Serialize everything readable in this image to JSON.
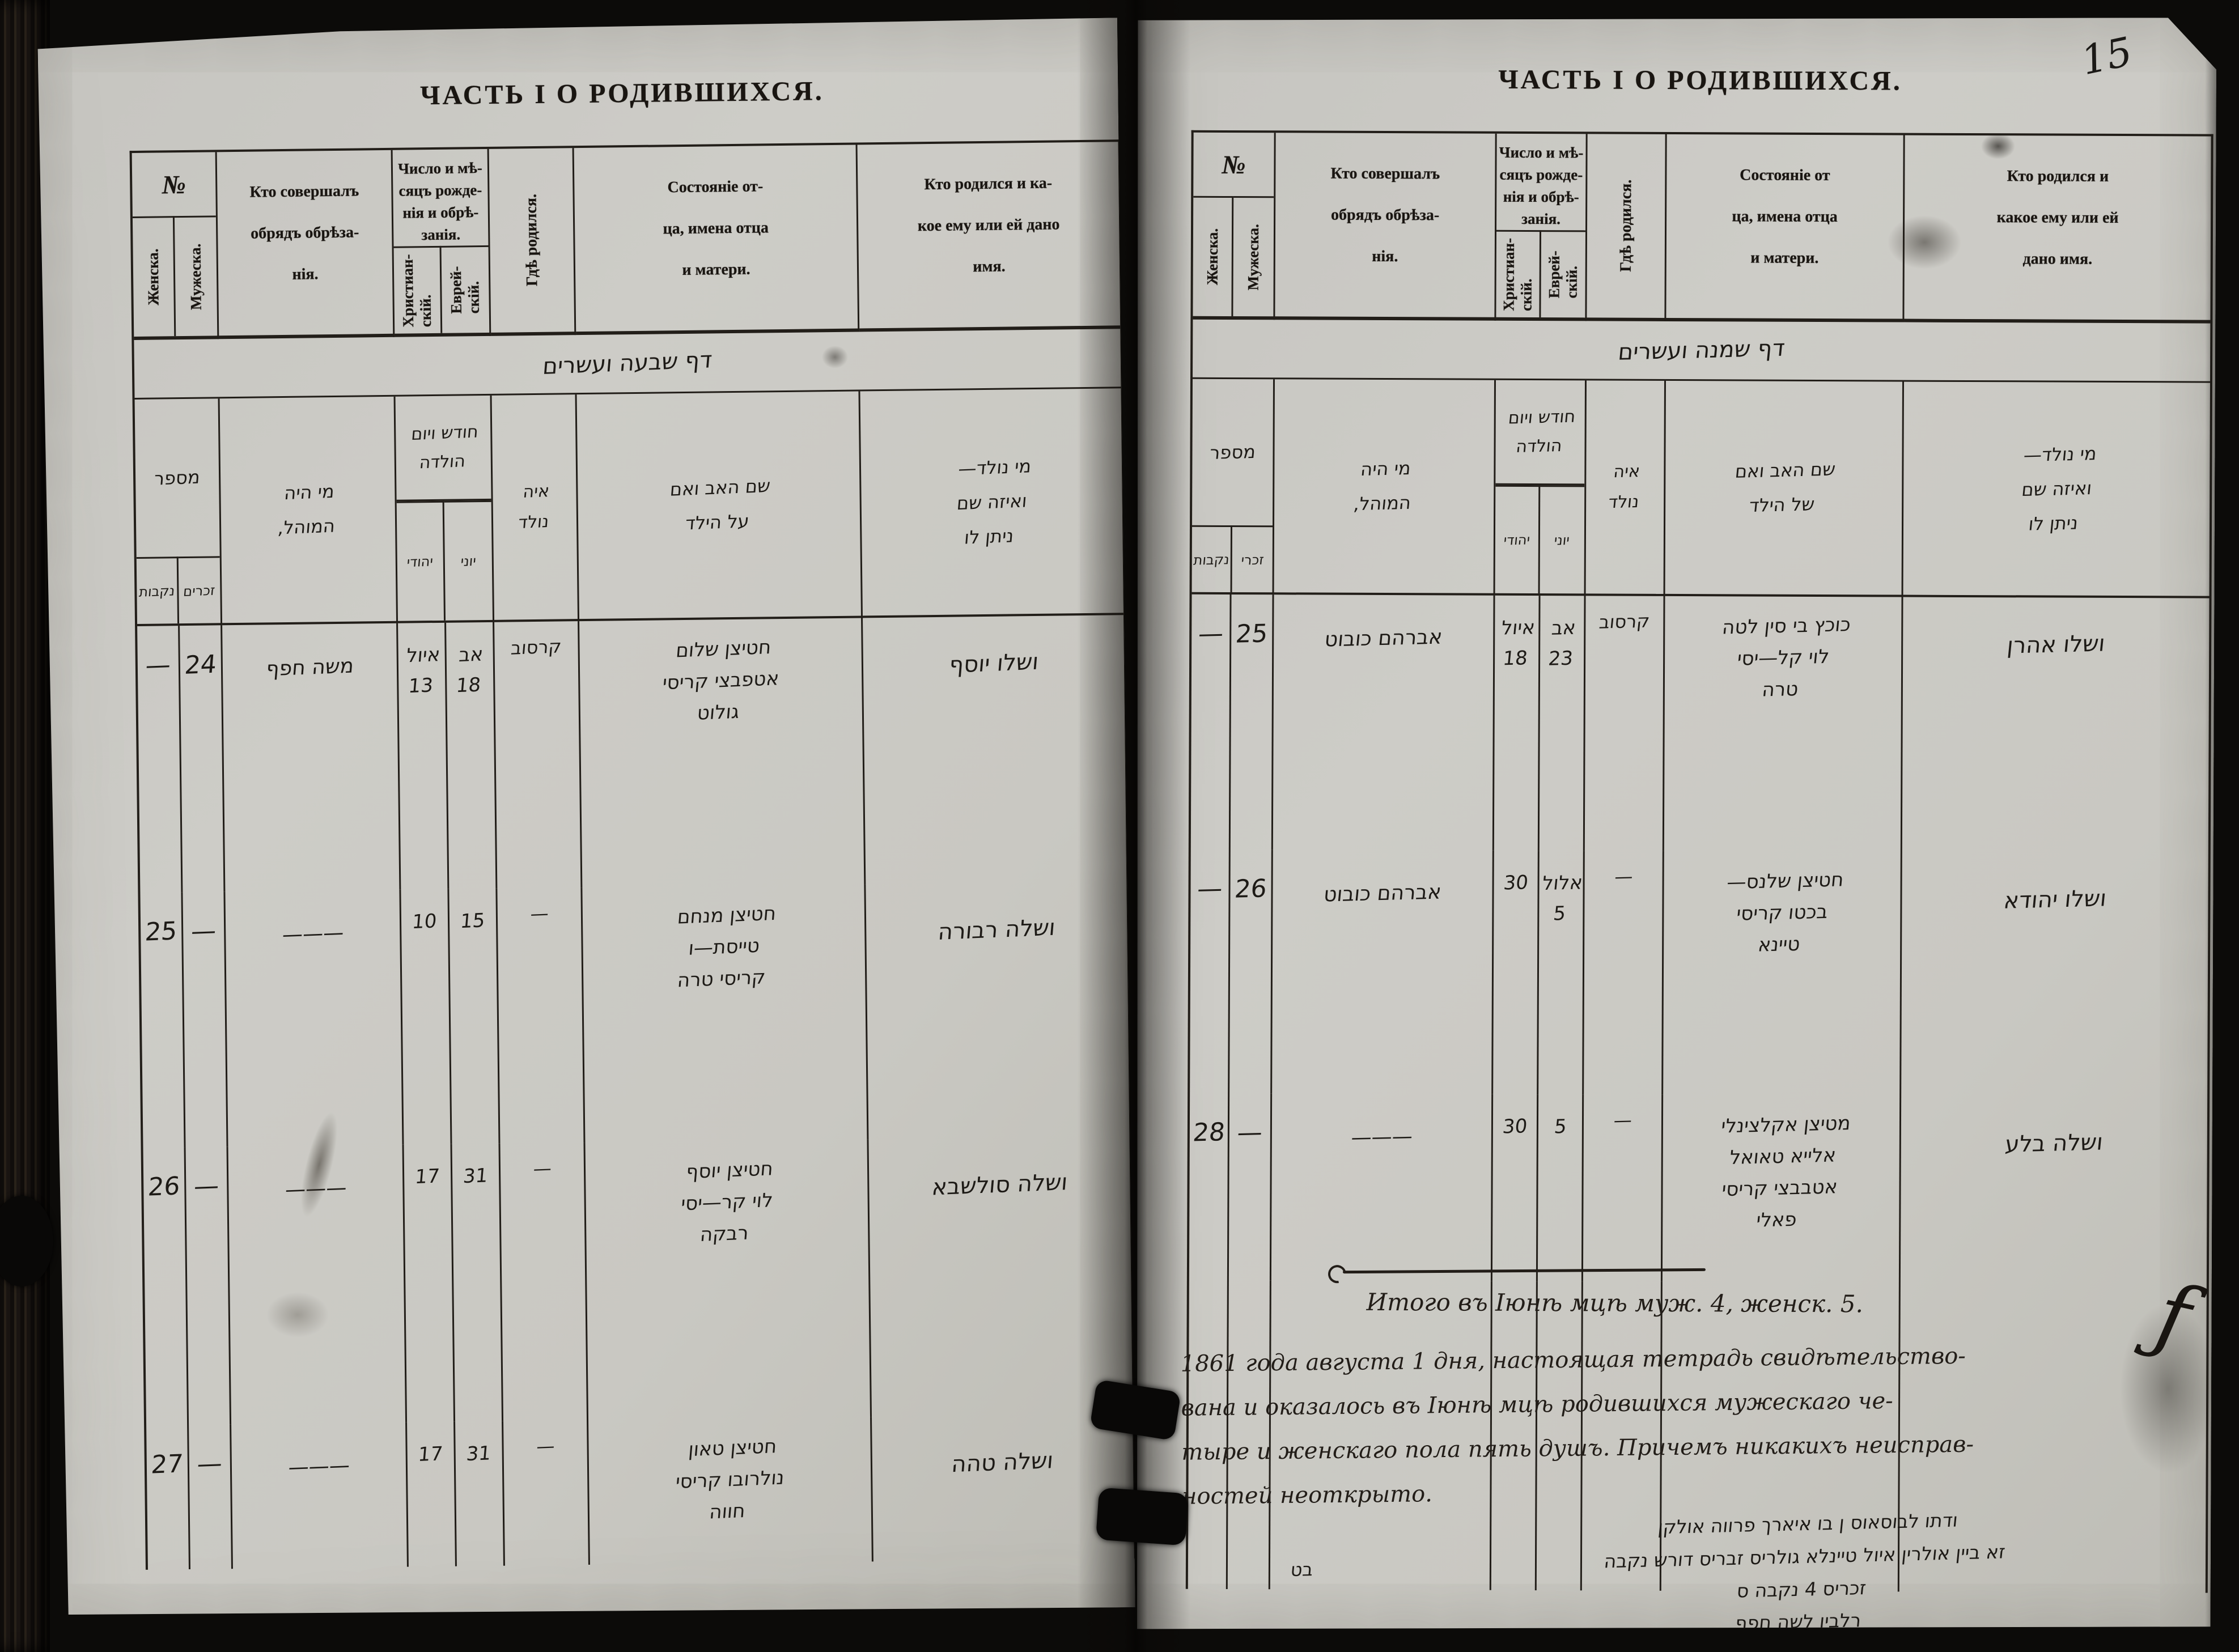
{
  "page_number": "15",
  "left_page": {
    "title": "ЧАСТЬ I О РОДИВШИХСЯ.",
    "printed": {
      "no": "№",
      "female": "Женска.",
      "male": "Мужеска.",
      "mohel": "Кто совершалъ\nобрядъ обрѣза-\nнія.",
      "date": "Число и мѣ-\nсяцъ рожде-\nнія и обрѣ-\nзанія.",
      "christian": "Христиан-\nскій.",
      "jewish": "Еврей-\nскій.",
      "born": "Гдѣ родился.",
      "father": "Состояніе от-\nца, имена отца\nи матери.",
      "name": "Кто родился и ка-\nкое ему или ей дано\nимя."
    },
    "hebrew_banner": "דף שבעה ועשרים",
    "hebrew": {
      "number": "מספר",
      "females": "נקבות",
      "males": "זכרים",
      "mohel": "מי היה\nהמוהל,",
      "date": "חודש ויום\nהולדה",
      "sub_christian": "יהודי",
      "sub_jewish": "יוני",
      "born": "איה\nנולד",
      "father": "שם האב ואם\nעל הילד",
      "name": "מי נולד—\nואיזה שם\nניתן לו"
    },
    "rows": [
      {
        "female": "—",
        "male": "24",
        "mohel": "משה חפף",
        "christian": "איול\n13",
        "jewish": "אב\n18",
        "born": "קרסוב",
        "parents": "חטיצן שלום\nאטפבצי קריסי\nגולוט",
        "child": "ושלו יוסף"
      },
      {
        "female": "25",
        "male": "—",
        "mohel": "———",
        "christian": "10",
        "jewish": "15",
        "born": "—",
        "parents": "חטיצן מנחם\nטייסת—ו\nקריסי טרה",
        "child": "ושלה רבורה"
      },
      {
        "female": "26",
        "male": "—",
        "mohel": "———",
        "christian": "17",
        "jewish": "31",
        "born": "—",
        "parents": "חטיצן יוסף\nלוי קר—יסי\nרבקה",
        "child": "ושלה סולשבא"
      },
      {
        "female": "27",
        "male": "—",
        "mohel": "———",
        "christian": "17",
        "jewish": "31",
        "born": "—",
        "parents": "חטיצן טאון\nנולרובו קריסי\nחווה",
        "child": "ושלה טהה"
      }
    ]
  },
  "right_page": {
    "title": "ЧАСТЬ I О РОДИВШИХСЯ.",
    "printed": {
      "no": "№",
      "female": "Женска.",
      "male": "Мужеска.",
      "mohel": "Кто совершалъ\nобрядъ обрѣза-\nнія.",
      "date": "Число и мѣ-\nсяцъ рожде-\nнія и обрѣ-\nзанія.",
      "christian": "Христиан-\nскій.",
      "jewish": "Еврей-\nскій.",
      "born": "Гдѣ родился.",
      "father": "Состояніе от\nца, имена отца\nи матери.",
      "name": "Кто родился и\nкакое ему или ей\nдано имя."
    },
    "hebrew_banner": "דף שמנה ועשרים",
    "hebrew": {
      "number": "מספר",
      "females": "נקבות",
      "males": "זכרי",
      "mohel": "מי היה\nהמוהל,",
      "date": "חודש ויום\nהולדה",
      "sub_christian": "יהודי",
      "sub_jewish": "יוני",
      "born": "איה\nנולד",
      "father": "שם האב ואם\nשל הילד",
      "name": "מי נולד—\nואיזה שם\nניתן לו"
    },
    "rows": [
      {
        "female": "—",
        "male": "25",
        "mohel": "אברהם כובוט",
        "christian": "איול\n18",
        "jewish": "אב\n23",
        "born": "קרסוב",
        "parents": "כוכץ בי סין לטה\nלוי קל—יסי\nטרה",
        "child": "ושלו אהרן"
      },
      {
        "female": "—",
        "male": "26",
        "mohel": "אברהם כובוט",
        "christian": "30",
        "jewish": "אלול\n5",
        "born": "—",
        "parents": "חטיצן שלנס—\nבכטו קריסי\nטיינא",
        "child": "ושלו יהודא"
      },
      {
        "female": "28",
        "male": "—",
        "mohel": "———",
        "christian": "30",
        "jewish": "5",
        "born": "—",
        "parents": "מטיצן אקלצינלי\nאלייא טאואל\nאטבבצי קריסי\nפאלי",
        "child": "ושלה בלע"
      }
    ],
    "summary": {
      "itogo": "Итого въ Іюнѣ мцѣ муж. 4, женск. 5.",
      "attestation": "1861 года августа 1 дня, настоящая тетрадь свидѣтельство-\nвана и оказалось въ Іюнѣ мцѣ родившихся мужескаго че-\nтыре и женскаго пола пять душъ. Причемъ никакихъ неисправ-\nностей неоткрыто.",
      "hebrew_lines": "ודתו לבוסאוס ן בו איארך פרווה אולקן\nזא ביין אולרין איול טיינלא גולריס זבריס דורש נקבה\nזכריס 4 נקבה ס\nרלבין לשה חפף",
      "hebrew_side_note": "בט",
      "signature": "ƒ"
    }
  }
}
